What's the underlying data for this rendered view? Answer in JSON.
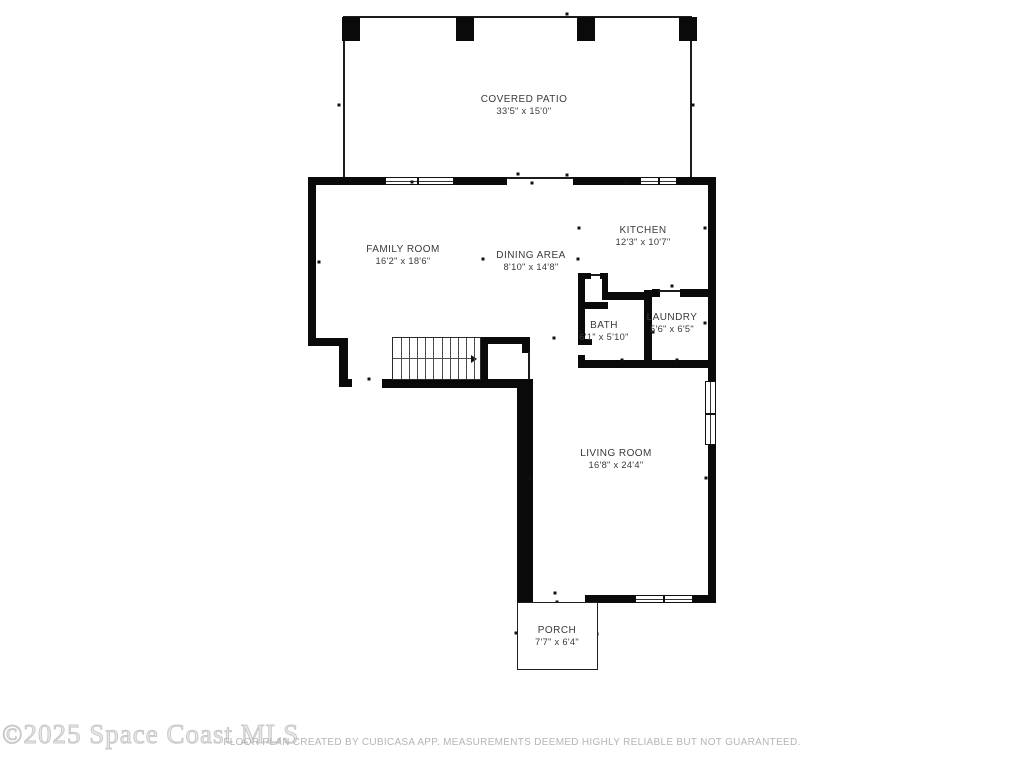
{
  "rooms": [
    {
      "name": "COVERED PATIO",
      "dims": "33'5\" x 15'0\""
    },
    {
      "name": "FAMILY ROOM",
      "dims": "16'2\" x 18'6\""
    },
    {
      "name": "DINING AREA",
      "dims": "8'10\" x 14'8\""
    },
    {
      "name": "KITCHEN",
      "dims": "12'3\" x 10'7\""
    },
    {
      "name": "BATH",
      "dims": "6'1\" x 5'10\""
    },
    {
      "name": "LAUNDRY",
      "dims": "5'6\" x 6'5\""
    },
    {
      "name": "LIVING ROOM",
      "dims": "16'8\" x 24'4\""
    },
    {
      "name": "PORCH",
      "dims": "7'7\" x 6'4\""
    }
  ],
  "stairs": {
    "arrow_direction": "right"
  },
  "watermark": "©2025 Space Coast MLS",
  "disclaimer": "FLOOR PLAN CREATED BY CUBICASA APP. MEASUREMENTS DEEMED HIGHLY RELIABLE BUT NOT GUARANTEED.",
  "colors": {
    "wall": "#0a0a0a",
    "label": "#3a3a3a",
    "watermark": "#d9d9d9",
    "footer": "#b5b5b5",
    "bg": "#ffffff"
  }
}
